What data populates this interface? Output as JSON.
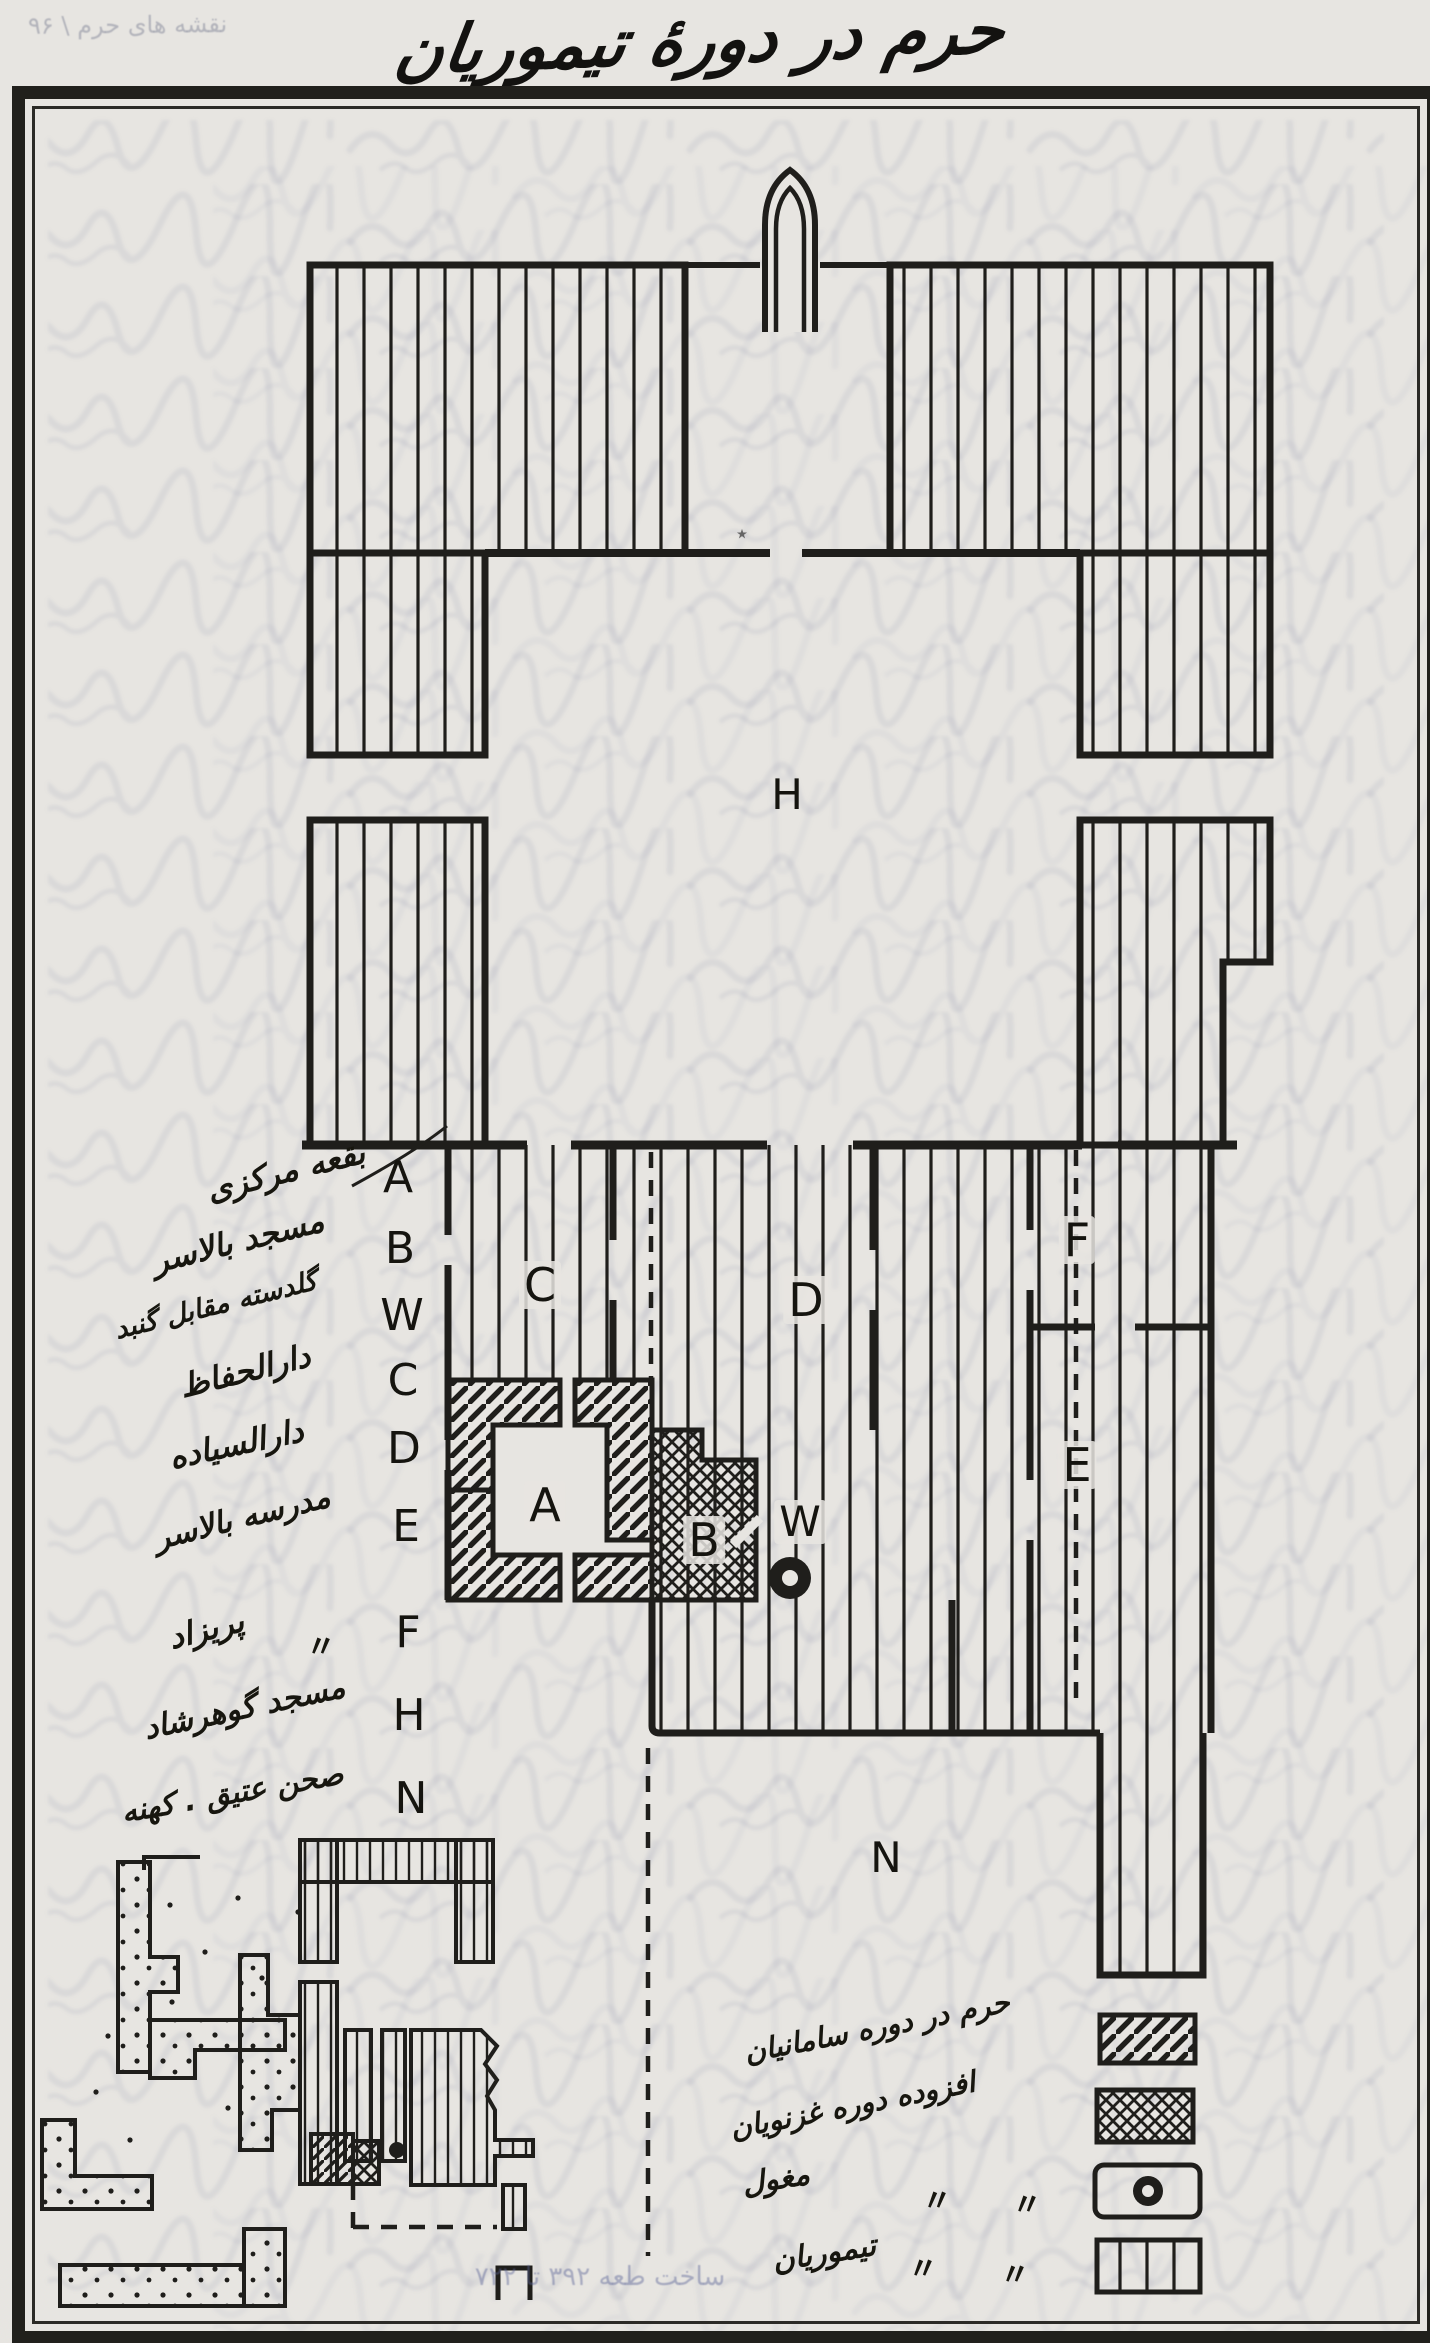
{
  "page": {
    "header_note": "نقشه های حرم \\ ۹۶",
    "title": "حرم در دورهٔ تیموریان",
    "footnote": "ساخت طعه ۳۹۲ تا ۷۲۲",
    "courtyard_mark": "٭",
    "ditto_mark": "〃"
  },
  "plan": {
    "area_labels": [
      {
        "letter": "A"
      },
      {
        "letter": "B"
      },
      {
        "letter": "W"
      },
      {
        "letter": "C"
      },
      {
        "letter": "D"
      },
      {
        "letter": "E"
      },
      {
        "letter": "F"
      },
      {
        "letter": "H"
      },
      {
        "letter": "N"
      }
    ],
    "key_list": [
      {
        "letter": "A",
        "label": "بقعه مرکزی"
      },
      {
        "letter": "B",
        "label": "مسجد بالاسر"
      },
      {
        "letter": "W",
        "label": "گلدسته مقابل گنبد"
      },
      {
        "letter": "C",
        "label": "دارالحفاظ"
      },
      {
        "letter": "D",
        "label": "دارالسیاده"
      },
      {
        "letter": "E",
        "label": "مدرسه بالاسر"
      },
      {
        "letter": "F",
        "label": "پریزاد"
      },
      {
        "letter": "H",
        "label": "مسجد گوهرشاد"
      },
      {
        "letter": "N",
        "label": "صحن عتیق . کهنه"
      }
    ],
    "legend": [
      {
        "label": "حرم در دوره سامانیان",
        "swatch": "diagonal-hatch"
      },
      {
        "label": "افزوده دوره غزنویان",
        "swatch": "cross-hatch"
      },
      {
        "label": "مغول",
        "swatch": "minaret-dot"
      },
      {
        "label": "تیموریان",
        "swatch": "vertical-stripes"
      }
    ],
    "colors": {
      "paper": "#e7e5e1",
      "ink": "#1f1e1b",
      "bleed": "#7d84a0"
    }
  }
}
